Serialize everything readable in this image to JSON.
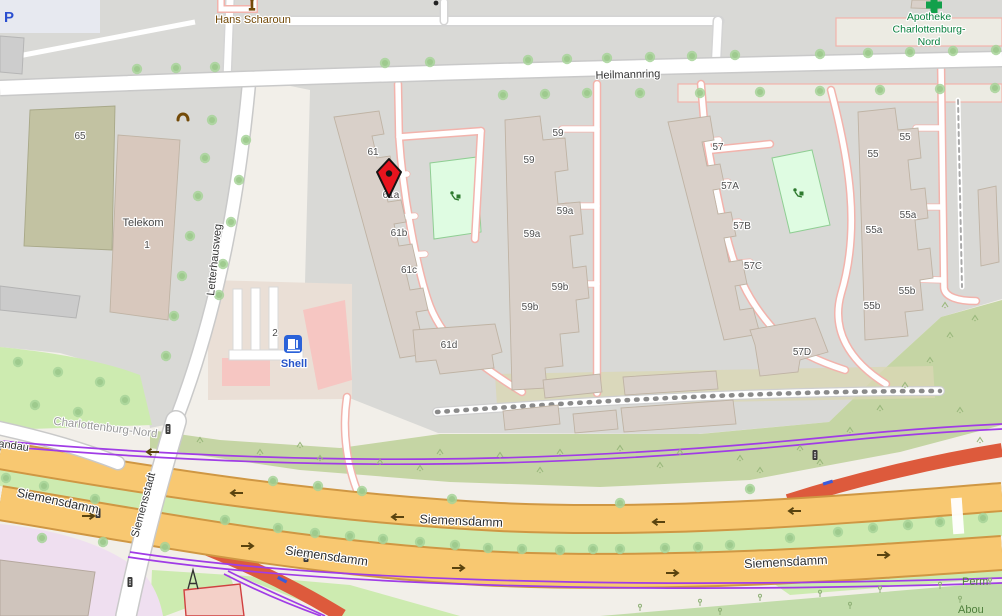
{
  "map": {
    "description": "OpenStreetMap-style street map of Charlottenburg-Nord, Berlin with red location marker near building 61a",
    "roads": {
      "heilmannring": "Heilmannring",
      "letterhausweg": "Letterhausweg",
      "siemensstadt": "Siemensstadt",
      "siemensdamm": "Siemensdamm",
      "spandau_partial": "pandau"
    },
    "district_label": "Charlottenburg-Nord",
    "pois": {
      "hans_scharoun": "Hans Scharoun",
      "apotheke_line1": "Apotheke",
      "apotheke_line2": "Charlottenburg-",
      "apotheke_line3": "Nord",
      "telekom": "Telekom",
      "telekom_housenumber": "1",
      "shell": "Shell",
      "shell_housenumber": "2",
      "parking": "P",
      "allotment_partial_line1": "Perm",
      "allotment_partial_line2": "Abou"
    },
    "housenumbers": {
      "b65": "65",
      "b61": "61",
      "b61a": "61a",
      "b61b": "61b",
      "b61c": "61c",
      "b61d": "61d",
      "b59": "59",
      "b59a": "59a",
      "b59b": "59b",
      "b57": "57",
      "b57A": "57A",
      "b57B": "57B",
      "b57C": "57C",
      "b57D": "57D",
      "b55": "55",
      "b55a": "55a",
      "b55b": "55b"
    },
    "icons": {
      "marker": "location-marker",
      "pharmacy": "pharmacy-cross-icon",
      "fuel": "fuel-pump-icon",
      "phone": "telephone-icon",
      "memorial": "memorial-statue-icon",
      "playground": "playground-icon",
      "traffic_light": "traffic-light-icon",
      "tower": "tower-icon",
      "bollard": "bollard-dot-icon",
      "oneway": "one-way-arrow-icon"
    },
    "colors": {
      "land": "#f2efe9",
      "residential": "#d9d9d6",
      "building": "#d9d0c9",
      "secondary_road_fill": "#f8c871",
      "secondary_road_casing": "#cf9743",
      "motorway_ramp": "#dd5a3c",
      "route_purple": "#a03ce6",
      "grass": "#cdebb0",
      "scrub": "#c5d5a4",
      "allotments": "#c2dcaa",
      "playground": "#dffce2",
      "marker_red": "#e8141e",
      "pharmacy_green": "#0c8040",
      "fuel_blue": "#2b62d9",
      "memorial_brown": "#734a08"
    }
  }
}
